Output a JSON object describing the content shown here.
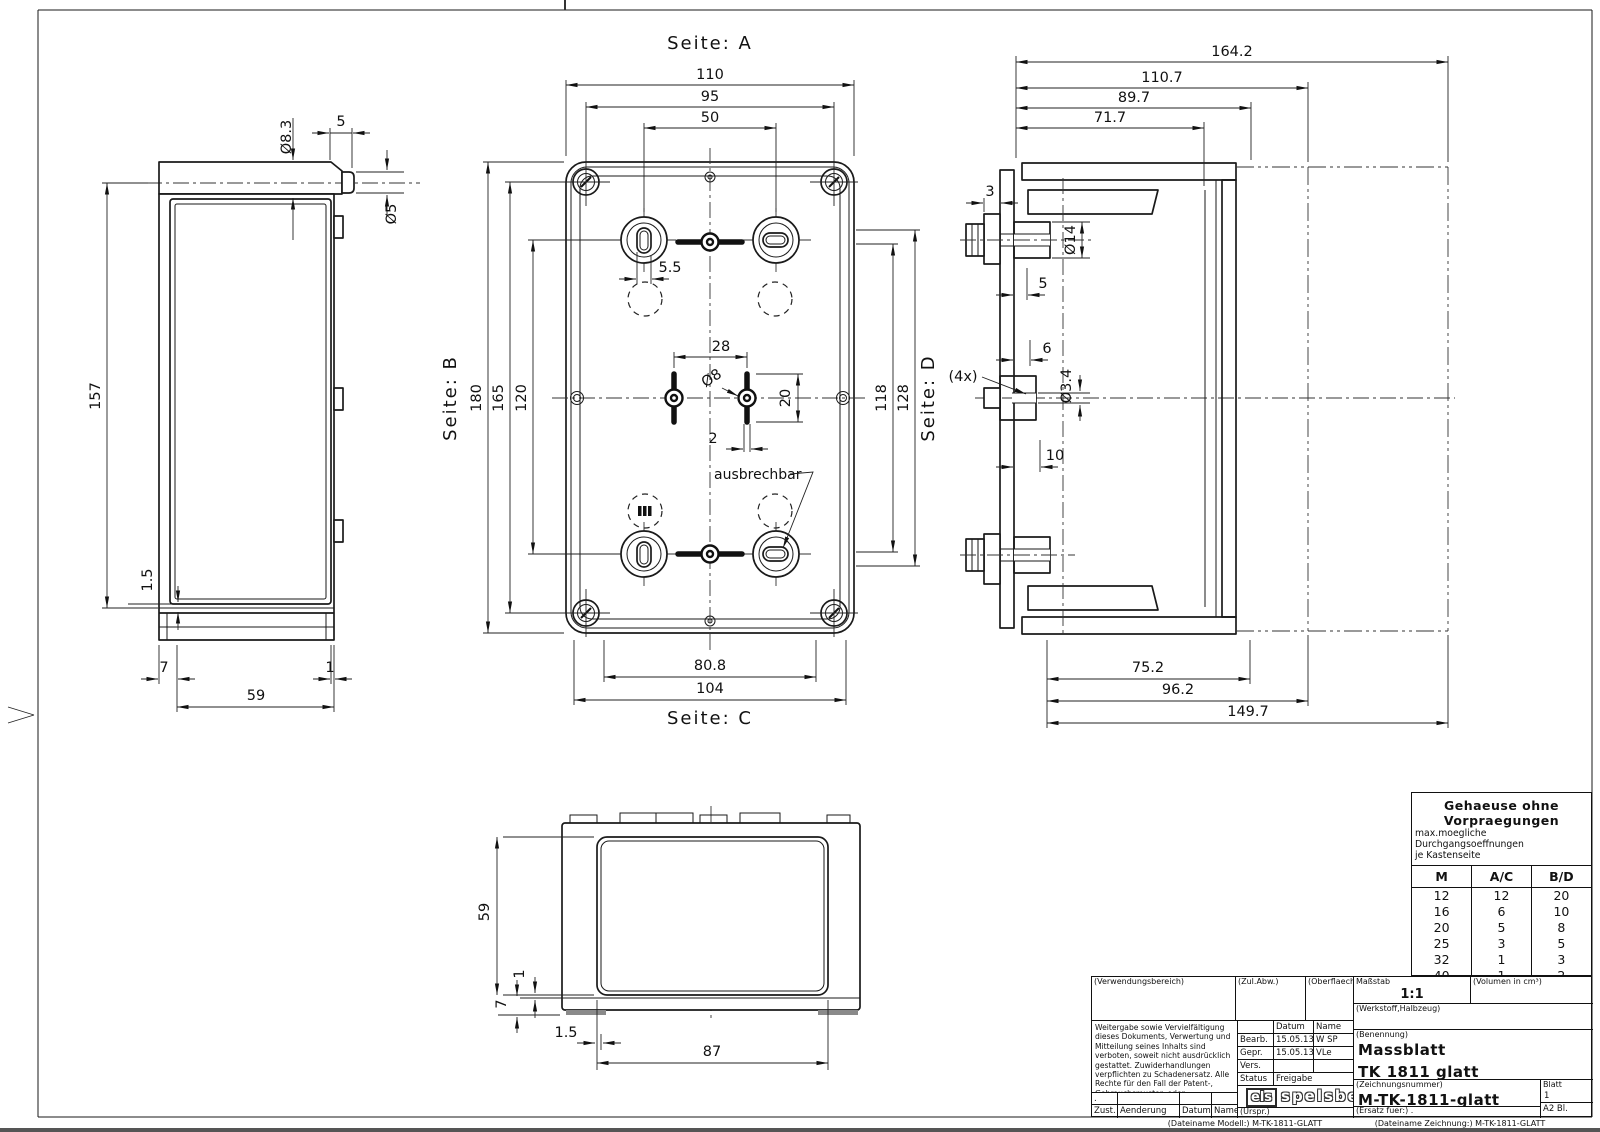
{
  "views": {
    "side": {
      "dims": {
        "pin_dia": "Ø8.3",
        "pin_length": "5",
        "pin_end_dia": "Ø5",
        "height": "157",
        "lid_gap": "1.5",
        "front_offset": "7",
        "rear_offset": "1",
        "depth": "59"
      }
    },
    "front": {
      "side_a": "Seite: A",
      "side_b": "Seite: B",
      "side_c": "Seite: C",
      "side_d": "Seite: D",
      "note_knockout": "ausbrechbar",
      "dims": {
        "width": "110",
        "screw_spacing_x": "95",
        "gland_spacing_x": "50",
        "height": "180",
        "screw_spacing_y": "165",
        "gland_spacing_y": "120",
        "slot_width": "5.5",
        "knockout_spacing": "28",
        "knockout_dia": "Ø8",
        "knockout_height": "20",
        "web_width": "2",
        "inner_spacing_y": "118",
        "outer_spacing_y": "128",
        "bottom_inner": "80.8",
        "bottom_outer": "104"
      }
    },
    "section": {
      "dims": {
        "total_depth": "164.2",
        "depth_open": "110.7",
        "depth_outer": "89.7",
        "depth_inner": "71.7",
        "wall": "3",
        "boss_dia": "Ø14",
        "flange_depth": "5",
        "rib_depth": "6",
        "screw_hole_dia": "Ø3.4",
        "screw_hole_count": "(4x)",
        "base_depth": "10",
        "bottom_inner": "75.2",
        "bottom_mid": "96.2",
        "bottom_total": "149.7"
      }
    },
    "bottom": {
      "dims": {
        "height": "59",
        "lip": "1",
        "foot": "7",
        "inset": "1.5",
        "width": "87"
      }
    }
  },
  "knockout_table": {
    "title": "Gehaeuse ohne Vorpraegungen",
    "subtitle1": "max.moegliche Durchgangsoeffnungen",
    "subtitle2": "je Kastenseite",
    "columns": [
      "M",
      "A/C",
      "B/D"
    ],
    "rows": [
      [
        "12",
        "12",
        "20"
      ],
      [
        "16",
        "6",
        "10"
      ],
      [
        "20",
        "5",
        "8"
      ],
      [
        "25",
        "3",
        "5"
      ],
      [
        "32",
        "1",
        "3"
      ],
      [
        "40",
        "1",
        "2"
      ],
      [
        "50",
        "1",
        "1"
      ]
    ]
  },
  "title_block": {
    "verwendungsbereich": "(Verwendungsbereich)",
    "zul_abw": "(Zul.Abw.)",
    "oberflaeche": "(Oberflaeche)",
    "massstab_label": "Maßstab",
    "massstab": "1:1",
    "volumen": "(Volumen in cm³)",
    "werkstoff": "(Werkstoff,Halbzeug)",
    "legal": "Weitergabe sowie Vervielfältigung dieses Dokuments, Verwertung und Mitteilung seines Inhalts sind verboten, soweit nicht ausdrücklich gestattet. Zuwiderhandlungen verpflichten zu Schadenersatz. Alle Rechte für den Fall der Patent-, Gebrauchsmuster- oder Geschmacksmustereintragung vorbehalten.",
    "approval": {
      "datum": "Datum",
      "name": "Name",
      "bearb_label": "Bearb.",
      "bearb_datum": "15.05.13",
      "bearb_name": "W SP",
      "gepr_label": "Gepr.",
      "gepr_datum": "15.05.13",
      "gepr_name": "VLe",
      "vers_label": "Vers.",
      "status_label": "Status",
      "status_value": "Freigabe"
    },
    "benennung_label": "(Benennung)",
    "benennung1": "Massblatt",
    "benennung2": "TK 1811 glatt",
    "zeichnungsnummer_label": "(Zeichnungsnummer)",
    "zeichnungsnummer": "M-TK-1811-glatt",
    "blatt_label": "Blatt",
    "blatt": "1",
    "format": "A2   Bl.",
    "ersatz": "(Ersatz fuer:)  .",
    "dot_row": ".",
    "zust": "Zust.",
    "aenderung": "Aenderung",
    "datum2": "Datum",
    "name2": "Name",
    "urspr": "(Urspr.)",
    "logo_els": "els",
    "logo_name": "spelsberg",
    "file_model": "(Dateiname Modell:) M-TK-1811-GLATT",
    "file_drawing": "(Dateiname Zeichnung:) M-TK-1811-GLATT"
  }
}
